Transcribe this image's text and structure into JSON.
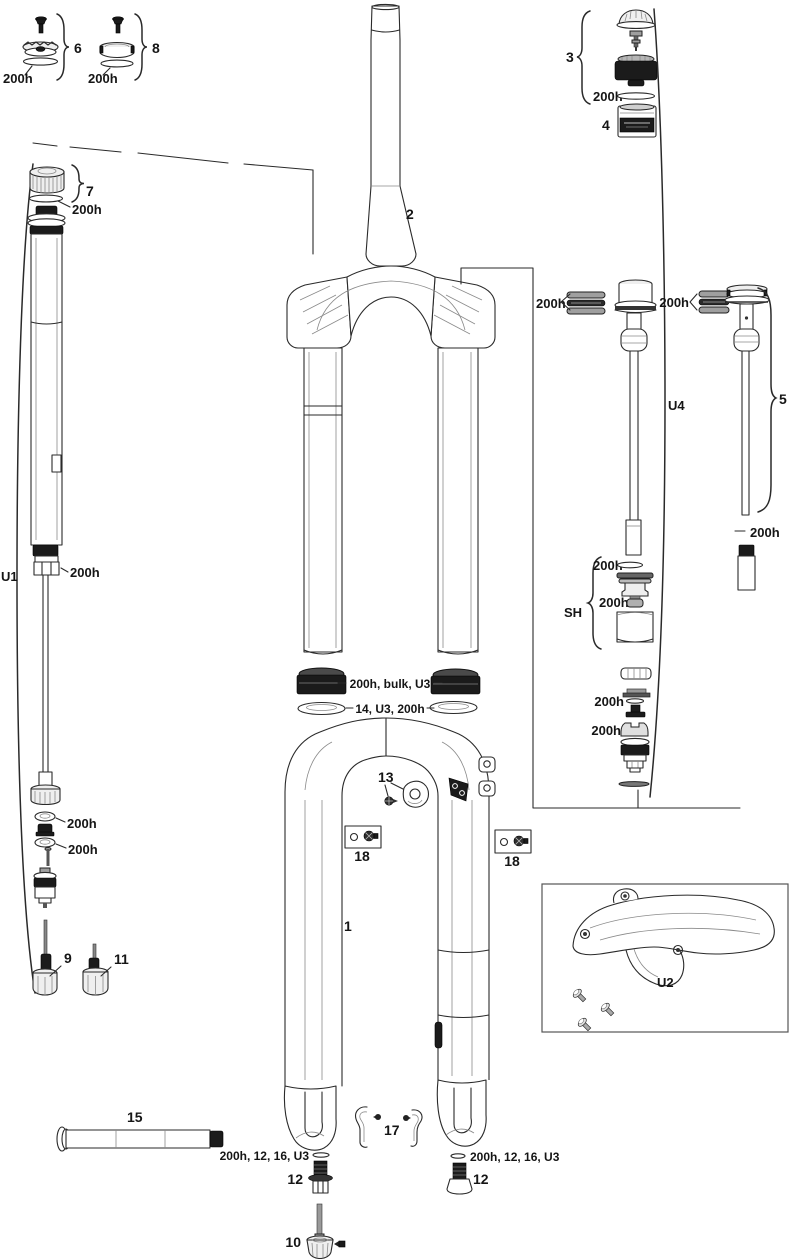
{
  "page": {
    "background": "#ffffff",
    "ink": "#231f20",
    "part_fill_black": "#1b1b1b"
  },
  "labels": {
    "n1": "1",
    "n2": "2",
    "n3": "3",
    "n4": "4",
    "n5": "5",
    "n6": "6",
    "n7": "7",
    "n8": "8",
    "n9": "9",
    "n10": "10",
    "n11": "11",
    "n12": "12",
    "n13": "13",
    "n15": "15",
    "n17": "17",
    "n18": "18",
    "service": "200h",
    "u1": "U1",
    "u2": "U2",
    "u4": "U4",
    "sh": "SH",
    "seal_kit": "200h, bulk, U3",
    "foam_ring_kit": "14, U3, 200h",
    "shaft_bolt_kit": "200h, 12, 16, U3"
  },
  "callout_instances": [
    "6",
    "200h",
    "8",
    "200h",
    "3",
    "200h",
    "4",
    "7",
    "200h",
    "2",
    "U1",
    "200h",
    "200h",
    "200h",
    "U4",
    "5",
    "200h",
    "SH",
    "200h",
    "200h",
    "200h",
    "200h",
    "200h",
    "200h, bulk, U3",
    "14, U3, 200h",
    "13",
    "18",
    "18",
    "1",
    "U2",
    "9",
    "11",
    "15",
    "17",
    "200h, 12, 16, U3",
    "12",
    "200h, 12, 16, U3",
    "12",
    "10"
  ]
}
